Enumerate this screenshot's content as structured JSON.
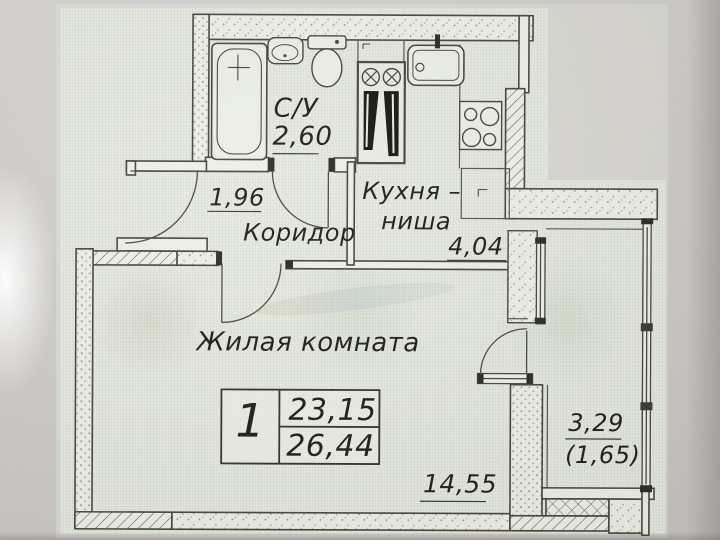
{
  "plan_type": "apartment floor plan",
  "rooms": {
    "bathroom": {
      "name": "С/У",
      "area": "2,60"
    },
    "hall": {
      "area": "1,96",
      "name": "Коридор"
    },
    "kitchen": {
      "name_line1": "Кухня –",
      "name_line2": "ниша",
      "area": "4,04"
    },
    "living": {
      "name": "Жилая комната",
      "area": "14,55"
    },
    "loggia": {
      "area": "3,29",
      "area_coefficient": "(1,65)"
    }
  },
  "summary": {
    "room_count": "1",
    "living_area": "23,15",
    "total_area": "26,44"
  },
  "colors": {
    "paper": "#e7eae1",
    "photo_background": "#cdcac7",
    "ink": "#45443f"
  }
}
